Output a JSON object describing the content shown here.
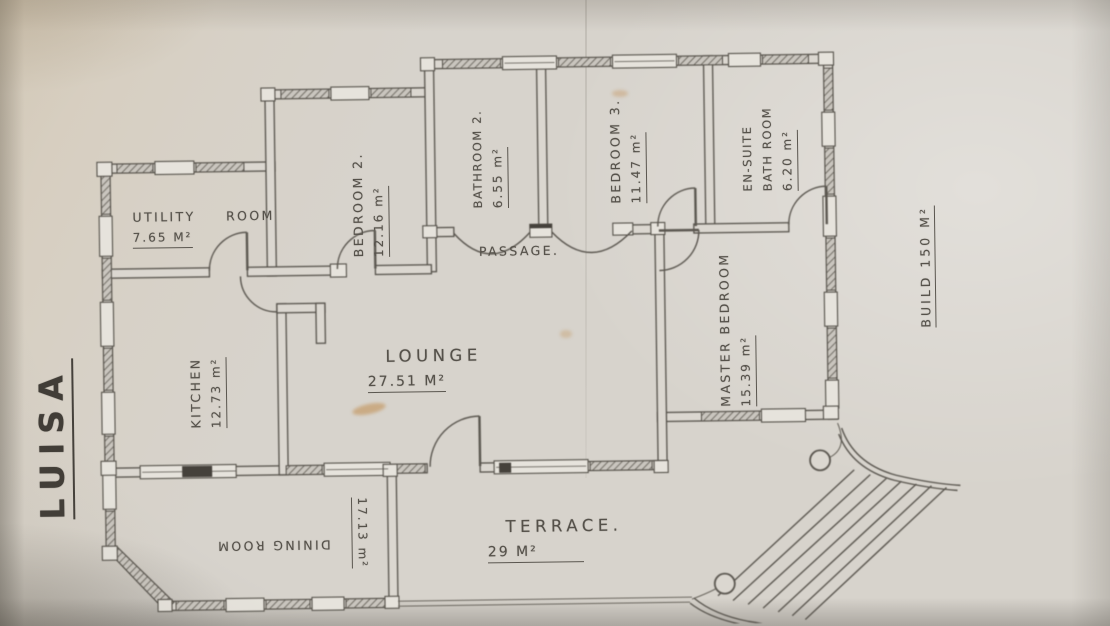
{
  "drawing_title": "LUISA",
  "build_area_note": "BUILD 150 M²",
  "colors": {
    "paper": "#d7d3cc",
    "ink": "#55514a",
    "stain": "#c08a4a"
  },
  "rooms": [
    {
      "name": "UTILITY ROOM",
      "area": "7.65 M²"
    },
    {
      "name": "BEDROOM 2.",
      "area": "12.16 m²"
    },
    {
      "name": "BATHROOM 2.",
      "area": "6.55 m²"
    },
    {
      "name": "BEDROOM 3.",
      "area": "11.47 m²"
    },
    {
      "name": "EN-SUITE",
      "name_line2": "BATH ROOM",
      "area": "6.20 m²"
    },
    {
      "name": "PASSAGE."
    },
    {
      "name": "MASTER BEDROOM",
      "area": "15.39 m²"
    },
    {
      "name": "KITCHEN",
      "area": "12.73 m²"
    },
    {
      "name": "LOUNGE",
      "area": "27.51 M²"
    },
    {
      "name": "DINING ROOM",
      "area": "17.13 m²"
    },
    {
      "name": "TERRACE.",
      "area": "29 M²"
    }
  ]
}
